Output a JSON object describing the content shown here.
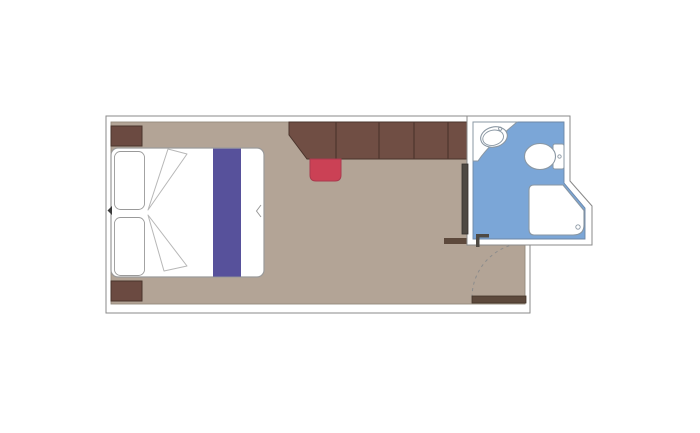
{
  "floor_plan": {
    "title": "Cabin stateroom floor plan",
    "rooms": [
      {
        "name": "cabin",
        "floor_color": "#b3a496"
      },
      {
        "name": "bathroom",
        "floor_color": "#7ba6d7"
      }
    ],
    "furniture": [
      {
        "name": "double-bed",
        "pillows": 2
      },
      {
        "name": "bed-runner"
      },
      {
        "name": "nightstand-top"
      },
      {
        "name": "nightstand-bottom"
      },
      {
        "name": "wardrobe",
        "sections": 5
      },
      {
        "name": "stool"
      },
      {
        "name": "bathroom-sliding-door"
      },
      {
        "name": "entry-door"
      }
    ],
    "fixtures": [
      {
        "name": "sink"
      },
      {
        "name": "toilet"
      },
      {
        "name": "shower"
      }
    ],
    "colors": {
      "background": "#ffffff",
      "wall_fill": "#ffffff",
      "wall_line": "#8a8a8a",
      "floor_line": "#948a7d",
      "cabin_floor": "#b3a496",
      "bathroom_floor": "#7ba6d7",
      "bathroom_floor_line": "#6d87a6",
      "wood_dark": "#6b4a41",
      "wood_outline": "#4a342c",
      "wardrobe": "#704e44",
      "wardrobe_divider": "#4e362e",
      "runner": "#57519b",
      "stool": "#cb4155",
      "stool_border": "#a93a4e",
      "door_wood": "#5d493c",
      "door_wood_outline": "#433528",
      "sliding_door": "#4e4943",
      "sliding_door_outline": "#35312d",
      "fixture_fill": "#ffffff",
      "fixture_line": "#8a97a3",
      "bed_fill": "#ffffff",
      "bed_line": "#9a9a9a",
      "fold_line": "#b7b7b7",
      "notch_dark": "#3a3a3a",
      "swing_arc": "#8c8c8c"
    }
  }
}
